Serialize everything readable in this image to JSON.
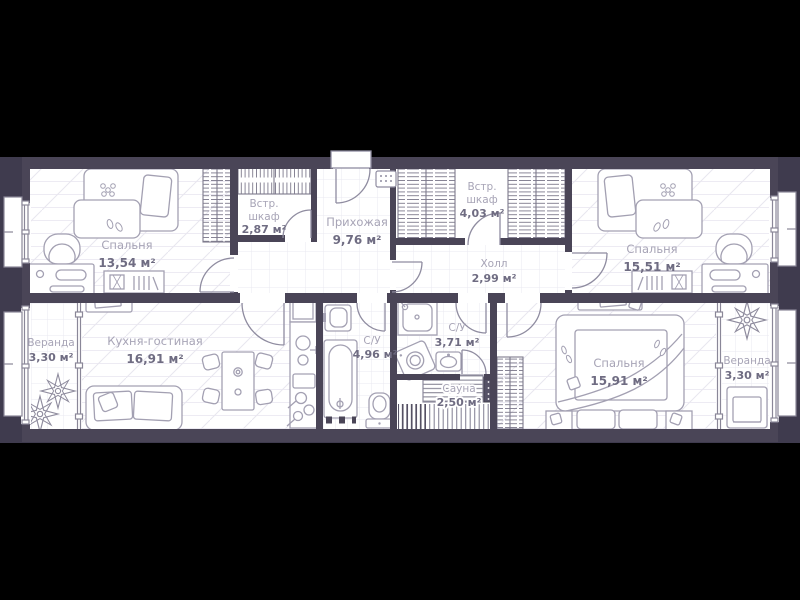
{
  "title": "Apartment floor plan",
  "colors": {
    "background": "#000000",
    "slab": "#3f3b4e",
    "wall": "#4a4557",
    "floor": "#ffffff",
    "furniture_line": "#a3a0b2",
    "hatch_line": "#7d7a8c",
    "room_name_text": "#a7a4b6",
    "room_area_text": "#6f6c82"
  },
  "rooms": [
    {
      "id": "bedroom-left",
      "name_lines": [
        "Спальня"
      ],
      "area": "13,54 м²"
    },
    {
      "id": "closet-small",
      "name_lines": [
        "Встр.",
        "шкаф"
      ],
      "area": "2,87 м²"
    },
    {
      "id": "hallway",
      "name_lines": [
        "Прихожая"
      ],
      "area": "9,76 м²"
    },
    {
      "id": "closet-large",
      "name_lines": [
        "Встр.",
        "шкаф"
      ],
      "area": "4,03 м²"
    },
    {
      "id": "hall",
      "name_lines": [
        "Холл"
      ],
      "area": "2,99 м²"
    },
    {
      "id": "bedroom-top-right",
      "name_lines": [
        "Спальня"
      ],
      "area": "15,51 м²"
    },
    {
      "id": "veranda-left",
      "name_lines": [
        "Веранда"
      ],
      "area": "3,30 м²"
    },
    {
      "id": "kitchen-living",
      "name_lines": [
        "Кухня-гостиная"
      ],
      "area": "16,91 м²"
    },
    {
      "id": "bathroom-large",
      "name_lines": [
        "С/У"
      ],
      "area": "4,96 м²"
    },
    {
      "id": "bathroom-small",
      "name_lines": [
        "С/У"
      ],
      "area": "3,71 м²"
    },
    {
      "id": "sauna",
      "name_lines": [
        "Сауна"
      ],
      "area": "2,50 м²"
    },
    {
      "id": "bedroom-bottom-right",
      "name_lines": [
        "Спальня"
      ],
      "area": "15,91 м²"
    },
    {
      "id": "veranda-right",
      "name_lines": [
        "Веранда"
      ],
      "area": "3,30 м²"
    }
  ],
  "furniture_icons": [
    "bed",
    "pillow",
    "blanket",
    "slippers",
    "armchair",
    "desk",
    "bookshelf",
    "wardrobe",
    "tv-stand",
    "sofa",
    "dining-table",
    "chair",
    "kitchen-counter",
    "stove",
    "kitchen-sink",
    "cooktop",
    "bathroom-sink",
    "bathtub",
    "toilet",
    "shower",
    "washing-machine",
    "sauna-bench",
    "sauna-heater",
    "duckboard",
    "plant",
    "veranda-armchair",
    "nightstand",
    "electrical-panel",
    "entrance-door",
    "window"
  ]
}
